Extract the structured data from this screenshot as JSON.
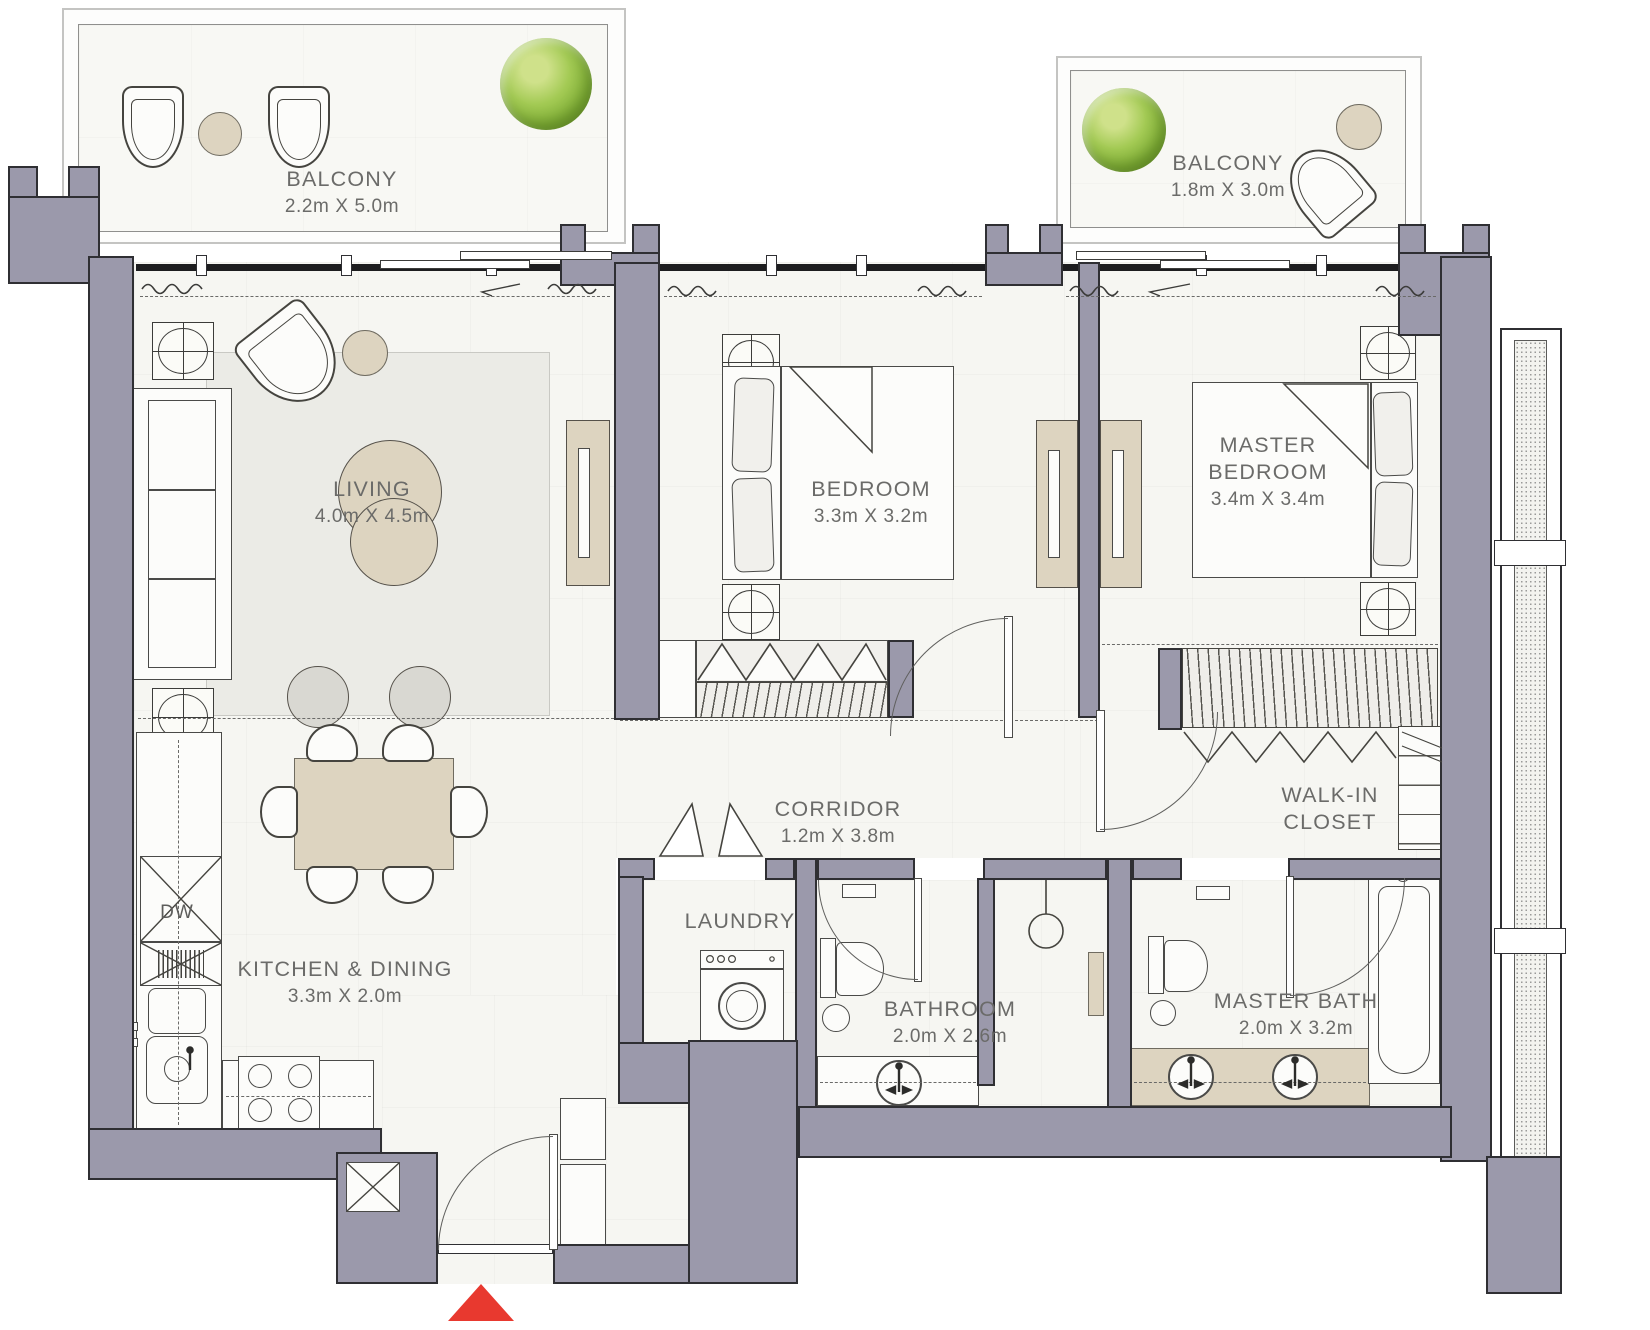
{
  "floorplan": {
    "rooms": {
      "balcony_left": {
        "name": "BALCONY",
        "dims": "2.2m X 5.0m"
      },
      "balcony_right": {
        "name": "BALCONY",
        "dims": "1.8m X 3.0m"
      },
      "living": {
        "name": "LIVING",
        "dims": "4.0m X 4.5m"
      },
      "bedroom": {
        "name": "BEDROOM",
        "dims": "3.3m X 3.2m"
      },
      "master_bedroom": {
        "name_line1": "MASTER",
        "name_line2": "BEDROOM",
        "dims": "3.4m X 3.4m"
      },
      "corridor": {
        "name": "CORRIDOR",
        "dims": "1.2m X 3.8m"
      },
      "walk_in_closet": {
        "name_line1": "WALK-IN",
        "name_line2": "CLOSET"
      },
      "laundry": {
        "name": "LAUNDRY"
      },
      "bathroom": {
        "name": "BATHROOM",
        "dims": "2.0m X 2.6m"
      },
      "master_bath": {
        "name": "MASTER BATH",
        "dims": "2.0m X 3.2m"
      },
      "kitchen_dining": {
        "name": "KITCHEN & DINING",
        "dims": "3.3m X 2.0m"
      }
    },
    "appliances": {
      "dishwasher": "DW"
    },
    "colors": {
      "wall": "#9b99ab",
      "accent_tan": "#ddd4c0",
      "entrance_arrow": "#e8392f",
      "tree": "#83b238",
      "label": "#6b6b69"
    }
  }
}
